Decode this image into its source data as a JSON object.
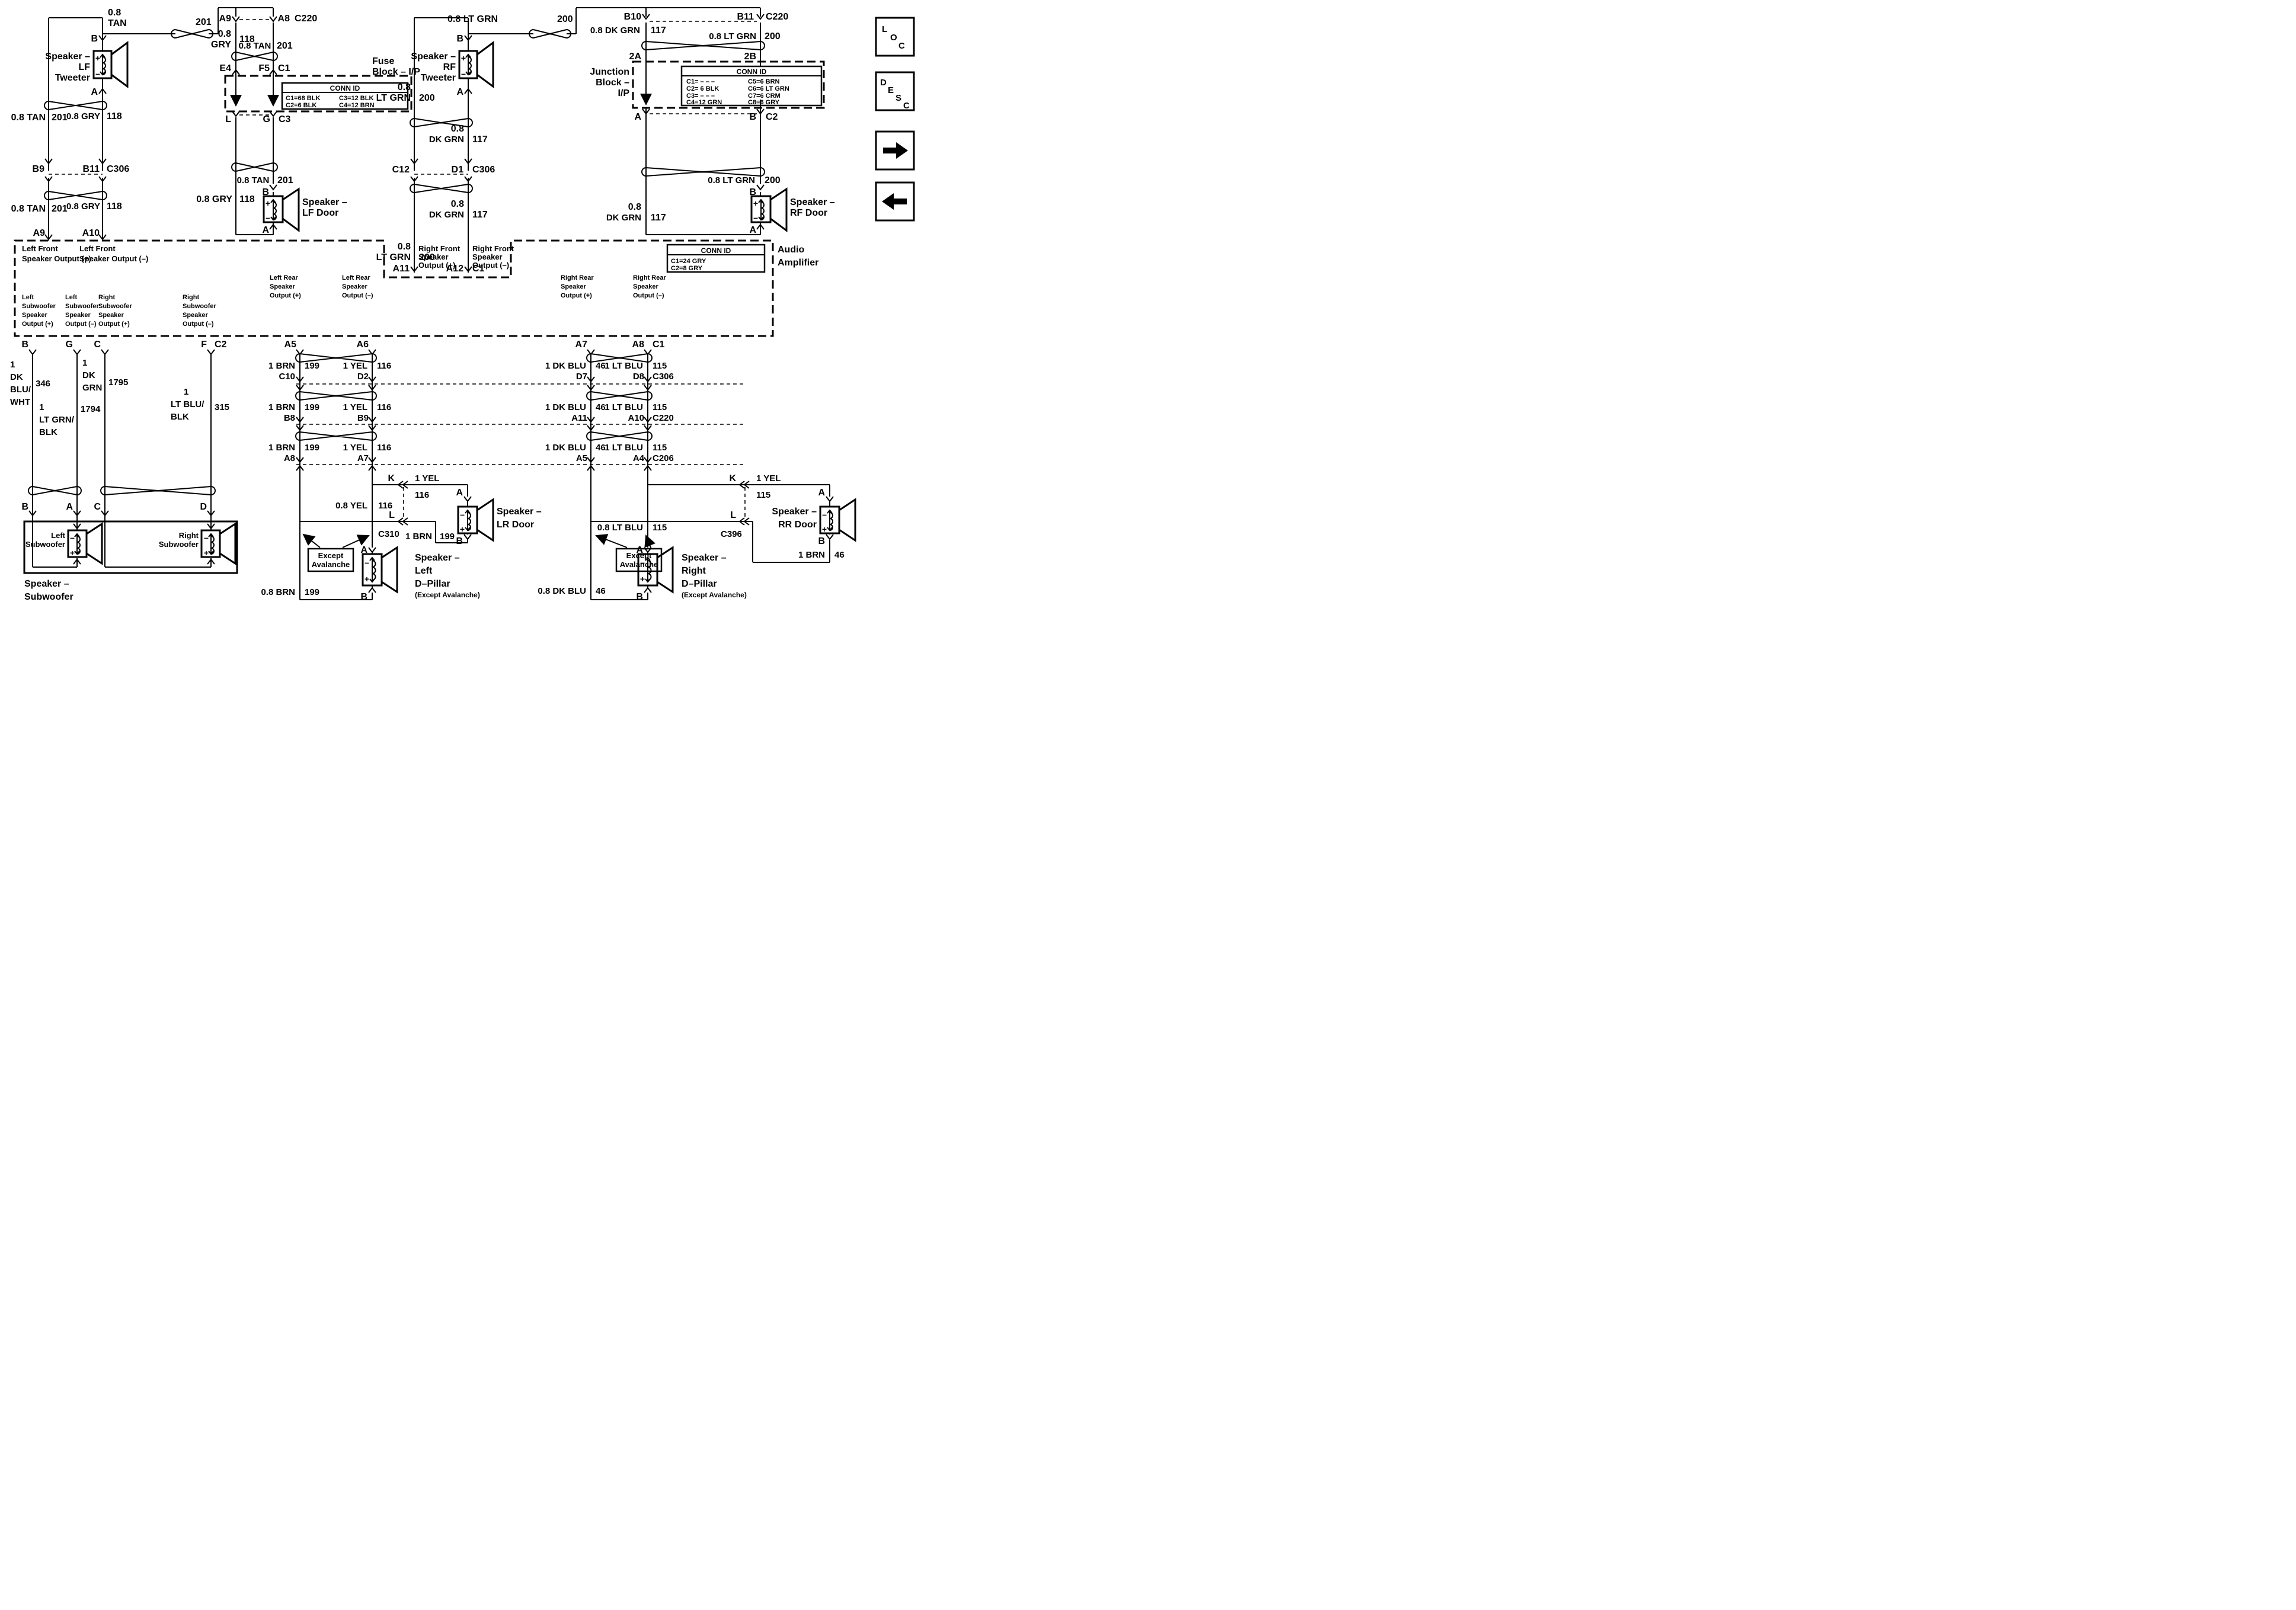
{
  "wires": {
    "tan": "0.8 TAN",
    "gry": "0.8 GRY",
    "ltgrn": "0.8 LT GRN",
    "dkgrn": "0.8 DK GRN",
    "yel": "0.8 YEL",
    "brn": "0.8 BRN",
    "ltblu": "0.8 LT BLU",
    "dkblu": "0.8 DK BLU",
    "brn1": "1 BRN",
    "yel1": "1 YEL",
    "dkblu1": "1 DK BLU",
    "ltblu1": "1 LT BLU",
    "n08": "0.8",
    "tan2": "TAN",
    "gry2": "GRY",
    "ltgrn2": "LT GRN",
    "dkgrn2": "DK GRN",
    "n1": "1",
    "dk": "DK",
    "blusl": "BLU/",
    "wht": "WHT",
    "grn": "GRN",
    "ltgrnsl": "LT GRN/",
    "blk": "BLK",
    "ltblusl": "LT BLU/"
  },
  "ckt": {
    "c115": "115",
    "c116": "116",
    "c117": "117",
    "c118": "118",
    "c199": "199",
    "c200": "200",
    "c201": "201",
    "c315": "315",
    "c346": "346",
    "c46": "46",
    "c1794": "1794",
    "c1795": "1795"
  },
  "pins": {
    "a": "A",
    "b": "B",
    "c": "C",
    "d": "D",
    "f": "F",
    "g": "G",
    "k": "K",
    "l": "L",
    "a2": "2A",
    "b2": "2B",
    "a4": "A4",
    "a5": "A5",
    "a6": "A6",
    "a7": "A7",
    "a8": "A8",
    "a9": "A9",
    "a10": "A10",
    "a11": "A11",
    "a12": "A12",
    "b8": "B8",
    "b9": "B9",
    "b10": "B10",
    "b11": "B11",
    "c1": "C1",
    "c2": "C2",
    "c3": "C3",
    "c10": "C10",
    "c12": "C12",
    "d1": "D1",
    "d2": "D2",
    "d7": "D7",
    "d8": "D8",
    "e4": "E4",
    "f5": "F5"
  },
  "conn": {
    "c206": "C206",
    "c220": "C220",
    "c306": "C306",
    "c310": "C310",
    "c396": "C396"
  },
  "blocks": {
    "fuse1": "Fuse",
    "fuse2": "Block – I/P",
    "jb1": "Junction",
    "jb2": "Block –",
    "jb3": "I/P",
    "amp1": "Audio",
    "amp2": "Amplifier",
    "connid": "CONN ID"
  },
  "spk": {
    "s": "Speaker –",
    "lf": "LF",
    "rf": "RF",
    "tw": "Tweeter",
    "lfd": "LF Door",
    "rfd": "RF Door",
    "lrd": "LR Door",
    "rrd": "RR Door",
    "left": "Left",
    "right": "Right",
    "sub": "Subwoofer",
    "dp": "D–Pillar",
    "exava": "(Except Avalanche)",
    "ex": "Except",
    "ava": "Avalanche",
    "p": "+",
    "m": "–"
  },
  "out": {
    "lf": "Left Front",
    "rf": "Right Front",
    "lr": "Left Rear",
    "rr": "Right Rear",
    "sp": "Speaker",
    "sop": "Speaker Output (+)",
    "som": "Speaker Output (–)",
    "op": "Output (+)",
    "om": "Output (–)"
  },
  "tables": {
    "fuse": [
      "C1=68 BLK",
      "C2=6 BLK",
      "C3=12 BLK",
      "C4=12 BRN"
    ],
    "junction": [
      "C1= – – –",
      "C2= 6 BLK",
      "C3= – – –",
      "C4=12 GRN",
      "C5=6 BRN",
      "C6=6 LT GRN",
      "C7=6 CRM",
      "C8=6 GRY"
    ],
    "amp": [
      "C1=24 GRY",
      "C2=8 GRY"
    ]
  },
  "nav": {
    "l1": "L",
    "l2": "O",
    "l3": "C",
    "d1": "D",
    "d2": "E",
    "d3": "S",
    "d4": "C"
  }
}
